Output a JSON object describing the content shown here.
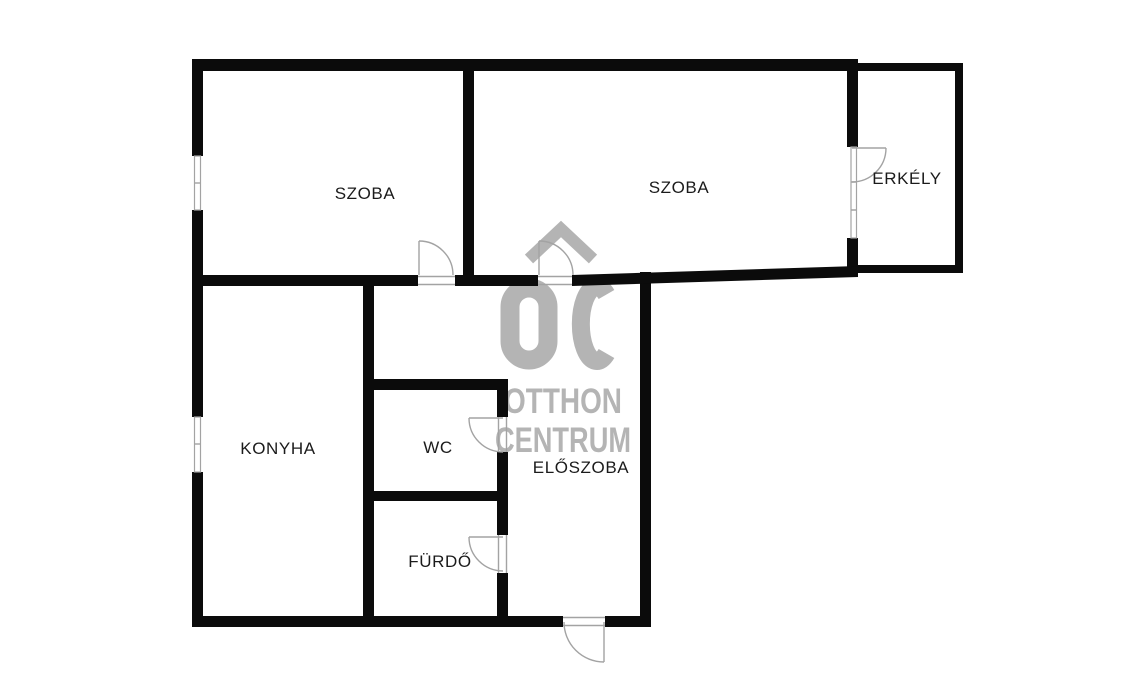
{
  "plan": {
    "width_px": 1123,
    "height_px": 679,
    "rooms": [
      {
        "name": "szoba-left",
        "label": "SZOBA"
      },
      {
        "name": "szoba-right",
        "label": "SZOBA"
      },
      {
        "name": "erkely",
        "label": "ERKÉLY"
      },
      {
        "name": "konyha",
        "label": "KONYHA"
      },
      {
        "name": "wc",
        "label": "WC"
      },
      {
        "name": "eloszoba",
        "label": "ELŐSZOBA"
      },
      {
        "name": "furdo",
        "label": "FÜRDŐ"
      }
    ]
  },
  "watermark": {
    "logo_text": "OC",
    "line1": "OTTHON",
    "line2": "CENTRUM"
  },
  "colors": {
    "background": "#ffffff",
    "wall": "#0b0b0b",
    "door_line": "#a3a3a3",
    "label": "#1b1b1b",
    "watermark": "#b4b4b4"
  }
}
